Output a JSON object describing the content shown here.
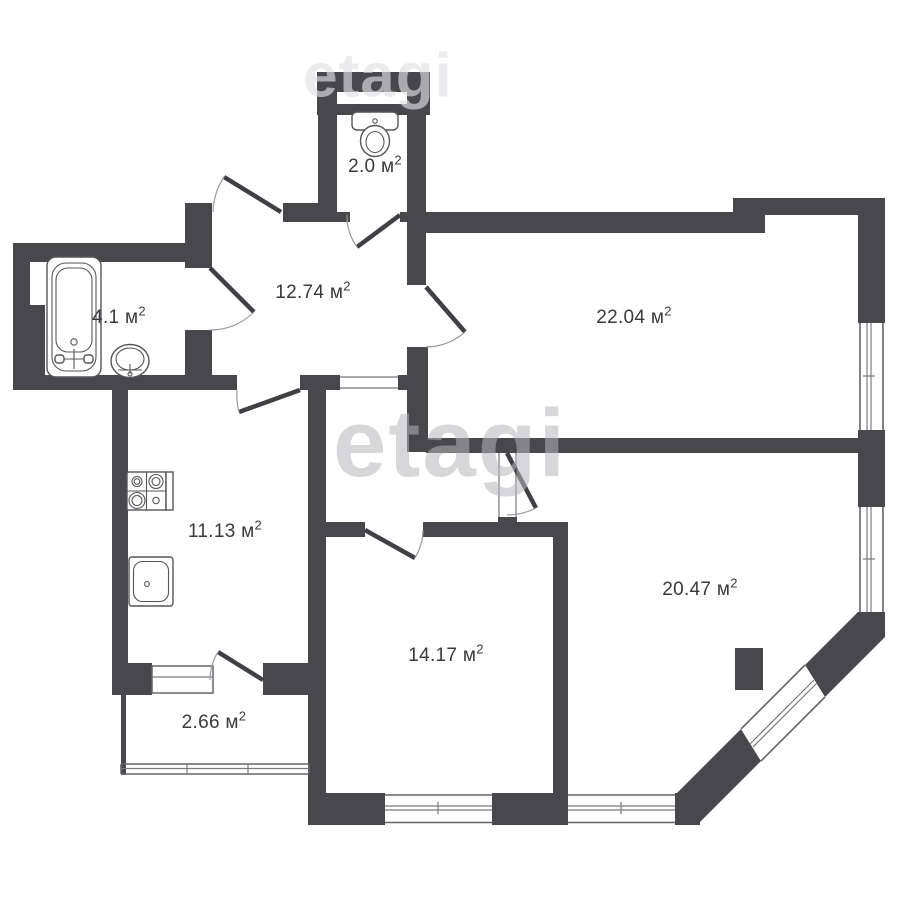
{
  "plan": {
    "background": "#ffffff",
    "wall_color": "#48484c",
    "label_color": "#3a3a3e",
    "unit_superscript": "2",
    "rooms": [
      {
        "label": "2.0 м",
        "sup": "2"
      },
      {
        "label": "12.74 м",
        "sup": "2"
      },
      {
        "label": "22.04 м",
        "sup": "2"
      },
      {
        "label": "4.1 м",
        "sup": "2"
      },
      {
        "label": "11.13 м",
        "sup": "2"
      },
      {
        "label": "14.17 м",
        "sup": "2"
      },
      {
        "label": "20.47 м",
        "sup": "2"
      },
      {
        "label": "2.66 м",
        "sup": "2"
      }
    ],
    "watermark": {
      "center_text": "etagi",
      "top_text": "etagi"
    }
  }
}
